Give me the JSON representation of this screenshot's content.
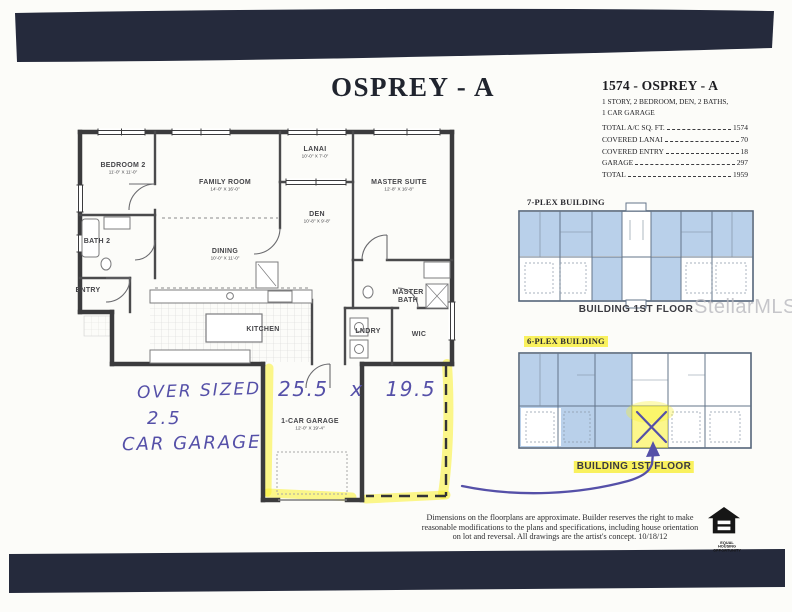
{
  "page": {
    "title": "OSPREY - A",
    "watermark": "StellarMLS",
    "bar_color": "#252a3c",
    "paper_color": "#fcfcf9"
  },
  "info_panel": {
    "title": "1574 - OSPREY - A",
    "subtitle_line1": "1 STORY, 2 BEDROOM, DEN, 2 BATHS,",
    "subtitle_line2": "1 CAR GARAGE",
    "rows": [
      {
        "label": "TOTAL A/C SQ. FT.",
        "value": "1574"
      },
      {
        "label": "COVERED LANAI",
        "value": "70"
      },
      {
        "label": "COVERED ENTRY",
        "value": "18"
      },
      {
        "label": "GARAGE",
        "value": "297"
      },
      {
        "label": "TOTAL",
        "value": "1959"
      }
    ]
  },
  "floorplan": {
    "rooms": [
      {
        "name": "BEDROOM 2",
        "dims": "11'-0\" X 11'-0\""
      },
      {
        "name": "FAMILY ROOM",
        "dims": "14'-0\" X 16'-0\""
      },
      {
        "name": "LANAI",
        "dims": "10'-0\" X 7'-0\""
      },
      {
        "name": "MASTER SUITE",
        "dims": "12'-8\" X 16'-8\""
      },
      {
        "name": "DEN",
        "dims": "10'-8\" X 9'-8\""
      },
      {
        "name": "DINING",
        "dims": "10'-0\" X 11'-0\""
      },
      {
        "name": "BATH 2",
        "dims": ""
      },
      {
        "name": "ENTRY",
        "dims": ""
      },
      {
        "name": "KITCHEN",
        "dims": ""
      },
      {
        "name": "LNDRY",
        "dims": ""
      },
      {
        "name": "WIC",
        "dims": ""
      },
      {
        "name": "MASTER BATH",
        "dims": ""
      },
      {
        "name": "1-CAR GARAGE",
        "dims": "12'-0\" X 19'-4\""
      }
    ]
  },
  "annotations": {
    "oversized_line1": "OVER SIZED",
    "oversized_line2": "2.5",
    "oversized_line3": "CAR GARAGE",
    "garage_dims_handwritten": "25.5 x 19.5",
    "ink_color": "#5550a8",
    "highlight_color": "#f8ee37"
  },
  "buildings": {
    "seven_plex": {
      "label": "7-PLEX BUILDING",
      "caption": "BUILDING 1ST FLOOR"
    },
    "six_plex": {
      "label": "6-PLEX BUILDING",
      "caption": "BUILDING 1ST FLOOR"
    },
    "unit_fill": "#b9d0ea"
  },
  "footer": {
    "disclaimer_line1": "Dimensions on the floorplans are approximate. Builder reserves the right to make",
    "disclaimer_line2": "reasonable modifications to the plans and specifications, including house orientation",
    "disclaimer_line3": "on lot and reversal. All drawings are the artist's concept.  10/18/12",
    "equal_housing_line1": "EQUAL HOUSING",
    "equal_housing_line2": "OPPORTUNITY"
  }
}
